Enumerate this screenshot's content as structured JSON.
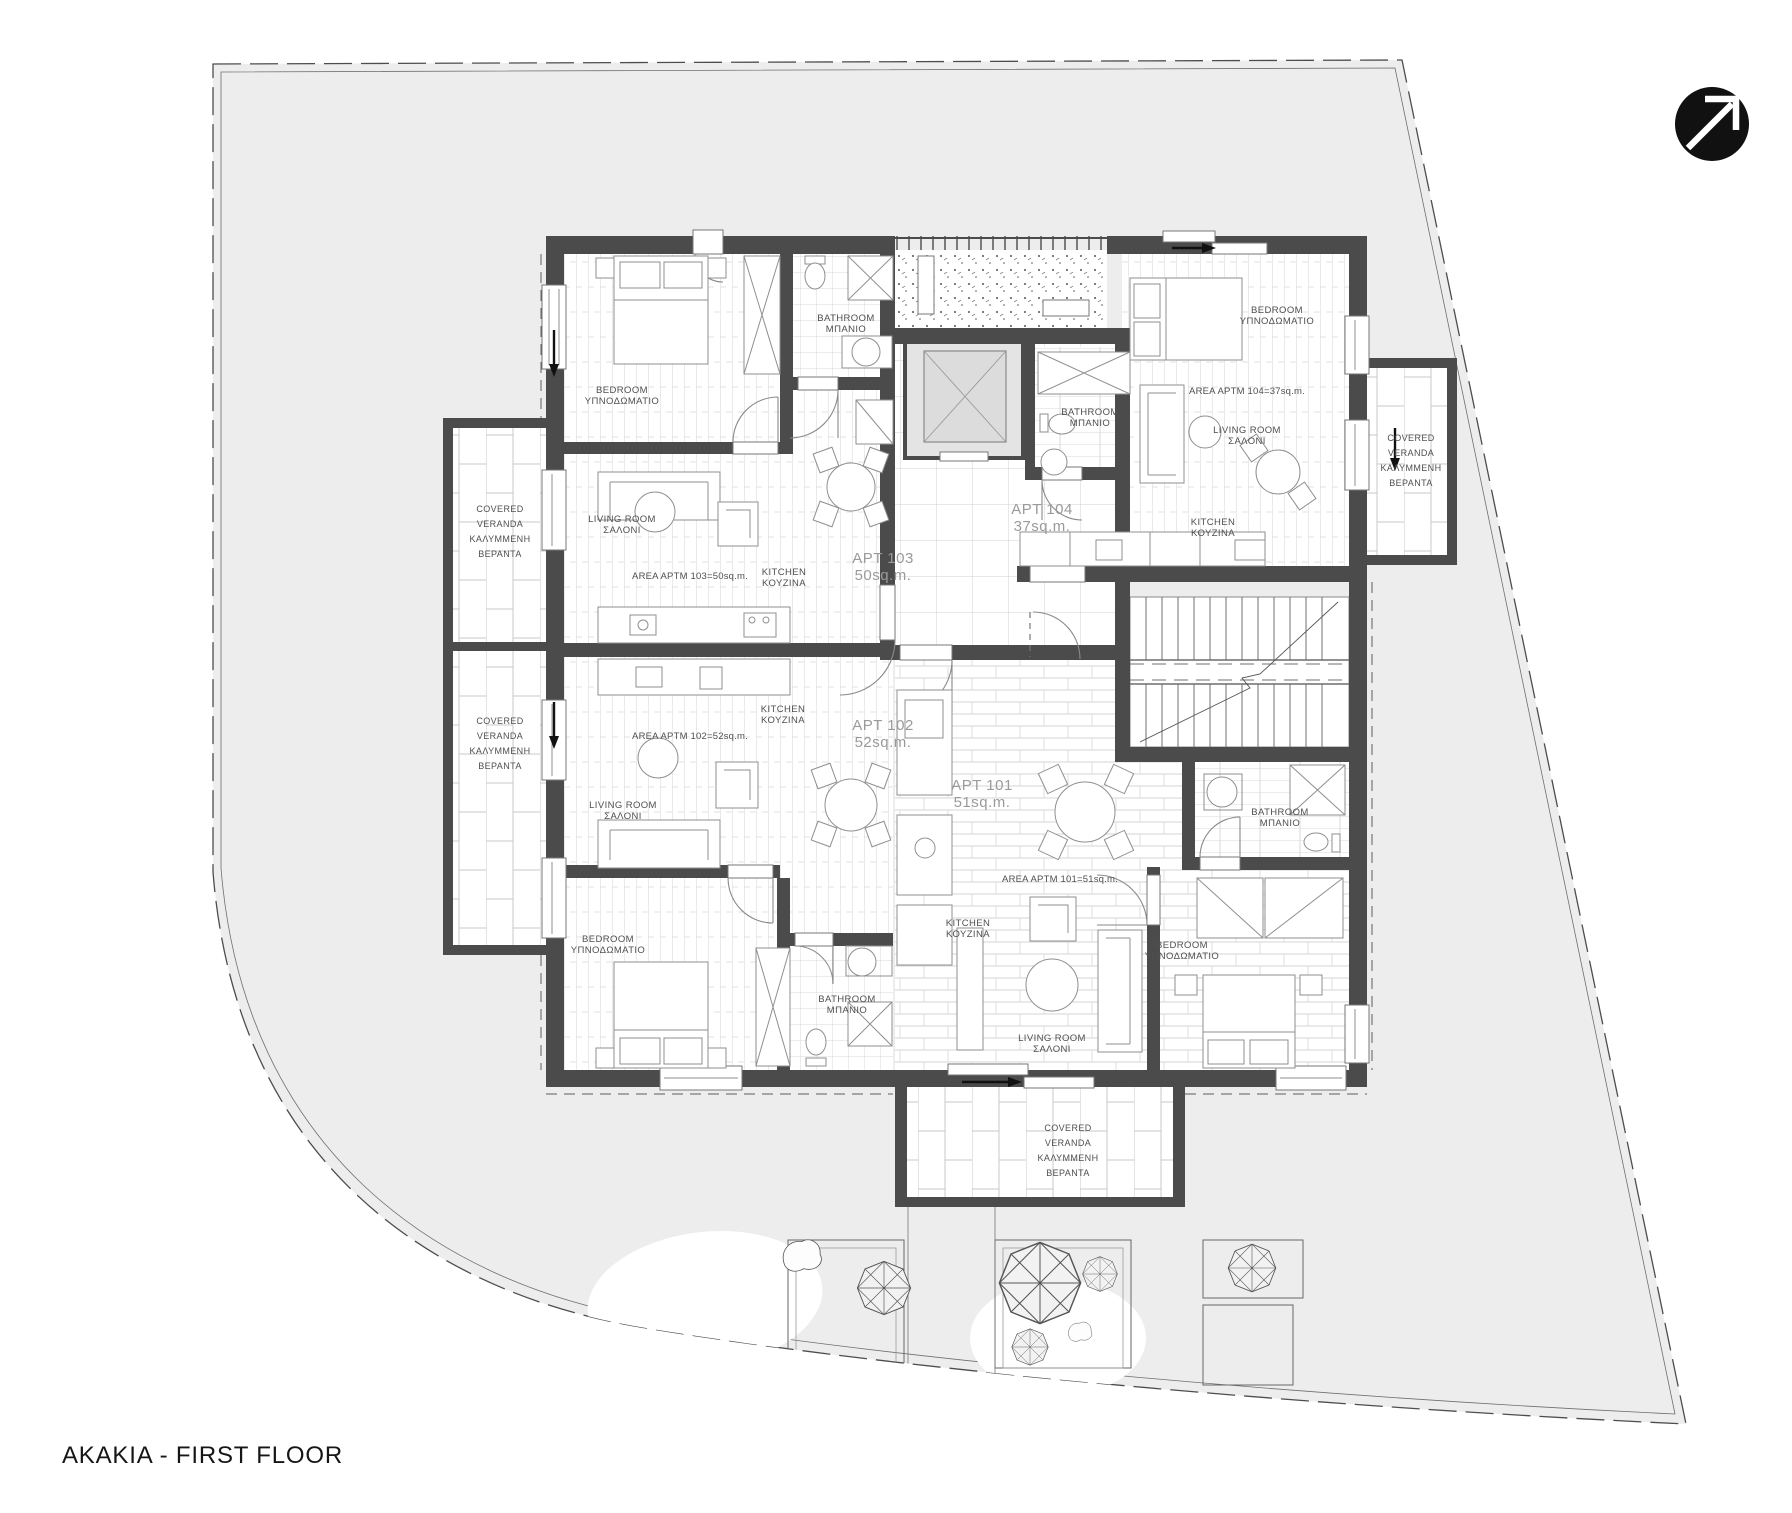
{
  "title": "AKAKIA - FIRST FLOOR",
  "labels": {
    "bedroom_en": "BEDROOM",
    "bedroom_gr": "ΥΠΝΟΔΩΜΑΤΙΟ",
    "living_en": "LIVING ROOM",
    "living_gr": "ΣΑΛΟΝΙ",
    "kitchen_en": "KITCHEN",
    "kitchen_gr": "ΚΟΥΖΙΝΑ",
    "bathroom_en": "BATHROOM",
    "bathroom_gr": "ΜΠΑΝΙΟ",
    "veranda_1": "COVERED",
    "veranda_2": "VERANDA",
    "veranda_3": "ΚΑΛΥΜΜΕΝΗ",
    "veranda_4": "ΒΕΡΑΝΤΑ"
  },
  "apartments": {
    "apt101": {
      "id": "APT 101",
      "area": "51sq.m.",
      "area_note": "AREA APTM 101=51sq.m."
    },
    "apt102": {
      "id": "APT 102",
      "area": "52sq.m.",
      "area_note": "AREA APTM 102=52sq.m."
    },
    "apt103": {
      "id": "APT 103",
      "area": "50sq.m.",
      "area_note": "AREA APTM 103=50sq.m."
    },
    "apt104": {
      "id": "APT 104",
      "area": "37sq.m.",
      "area_note": "AREA APTM 104=37sq.m."
    }
  },
  "colors": {
    "site_fill": "#ededed",
    "wall": "#4b4b4b",
    "logo": "#111111"
  }
}
